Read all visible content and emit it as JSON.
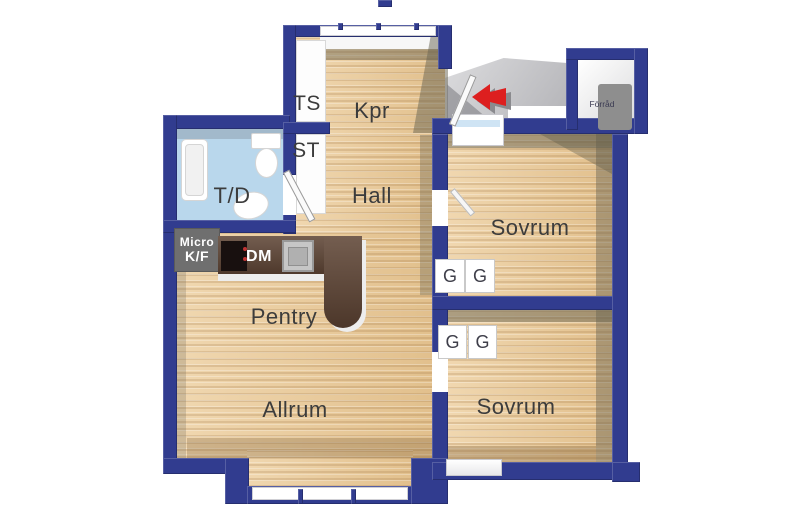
{
  "floorplan": {
    "rooms": {
      "kpr": "Kpr",
      "hall": "Hall",
      "bathroom": "T/D",
      "pantry": "Pentry",
      "living": "Allrum",
      "bedroom1": "Sovrum",
      "bedroom2": "Sovrum",
      "closet_ts": "TS",
      "closet_st": "ST",
      "storage": "Förråd"
    },
    "appliances": {
      "micro": "Micro",
      "fridge_freezer": "K/F",
      "dishwasher": "DM",
      "wardrobe": "G"
    },
    "icons": {
      "entrance_arrow": "red-left-arrow"
    },
    "colors": {
      "wall": "#313c8f",
      "floor_wood": "#e8c795",
      "floor_bath": "#b9d7ec",
      "counter": "#5d4333",
      "landing_gray": "#c9c9cc",
      "arrow_red": "#dd1f1f",
      "label_text": "#3c3c3c",
      "fixture_white": "#ffffff"
    }
  }
}
